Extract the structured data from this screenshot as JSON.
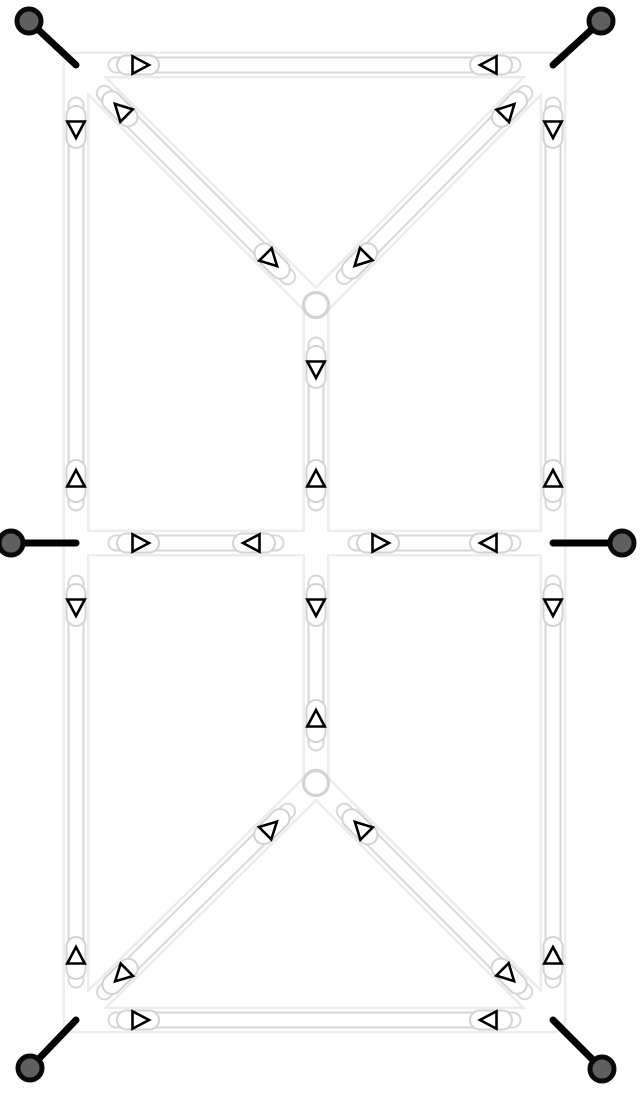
{
  "diagram": {
    "title": "truss-structure-force-diagram",
    "canvas": {
      "width": 644,
      "height": 1098,
      "background": "#ffffff"
    },
    "colors": {
      "halo_outline": "#ececec",
      "member_outline": "#d7d7d7",
      "member_fill": "#ffffff",
      "sleeve_outline": "#d2d2d2",
      "sleeve_fill": "#ffffff",
      "joint_outline": "#d2d2d2",
      "joint_fill": "#ffffff",
      "arrow_stroke": "#000000",
      "arrow_fill": "#ffffff",
      "rod_color": "#000000",
      "anchor_fill": "#5f5f5f",
      "anchor_stroke": "#0a0a0a"
    },
    "nodes": {
      "TL": [
        76,
        65
      ],
      "TR": [
        553,
        65
      ],
      "TC": [
        316,
        305
      ],
      "ML": [
        76,
        543
      ],
      "C": [
        316,
        543
      ],
      "MR": [
        553,
        543
      ],
      "BC": [
        316,
        783
      ],
      "BL": [
        76,
        1020
      ],
      "BR": [
        553,
        1020
      ]
    },
    "members": [
      {
        "from": "TL",
        "to": "TR",
        "force": "tension"
      },
      {
        "from": "TL",
        "to": "ML",
        "force": "tension"
      },
      {
        "from": "TR",
        "to": "MR",
        "force": "tension"
      },
      {
        "from": "TL",
        "to": "TC",
        "force": "compression"
      },
      {
        "from": "TR",
        "to": "TC",
        "force": "compression"
      },
      {
        "from": "TC",
        "to": "C",
        "force": "tension"
      },
      {
        "from": "ML",
        "to": "C",
        "force": "tension"
      },
      {
        "from": "C",
        "to": "MR",
        "force": "tension"
      },
      {
        "from": "C",
        "to": "BC",
        "force": "tension"
      },
      {
        "from": "ML",
        "to": "BL",
        "force": "tension"
      },
      {
        "from": "MR",
        "to": "BR",
        "force": "tension"
      },
      {
        "from": "BC",
        "to": "BL",
        "force": "compression"
      },
      {
        "from": "BC",
        "to": "BR",
        "force": "compression"
      },
      {
        "from": "BL",
        "to": "BR",
        "force": "tension"
      }
    ],
    "joints": [
      "TC",
      "BC"
    ],
    "anchors": [
      {
        "node": "TL",
        "x": 29,
        "y": 21
      },
      {
        "node": "TR",
        "x": 601,
        "y": 21
      },
      {
        "node": "ML",
        "x": 11,
        "y": 543
      },
      {
        "node": "MR",
        "x": 622,
        "y": 543
      },
      {
        "node": "BL",
        "x": 30,
        "y": 1068
      },
      {
        "node": "BR",
        "x": 602,
        "y": 1069
      }
    ],
    "geometry": {
      "halo_width": 27,
      "halo_inner_width": 22,
      "capsule_width": 17,
      "capsule_inner_width": 13,
      "capsule_end_inset": 40,
      "sleeve_length": 42,
      "sleeve_width": 19,
      "sleeve_offset": 62,
      "arrow_offset": 64,
      "arrow_tip": 9,
      "arrow_back": 7.5,
      "arrow_half_width": 8.75,
      "arrow_stroke_width": 2.6,
      "rod_width": 7,
      "joint_radius": 12.5,
      "joint_stroke_width": 3.2,
      "anchor_radius": 12,
      "anchor_stroke_width": 5
    }
  }
}
